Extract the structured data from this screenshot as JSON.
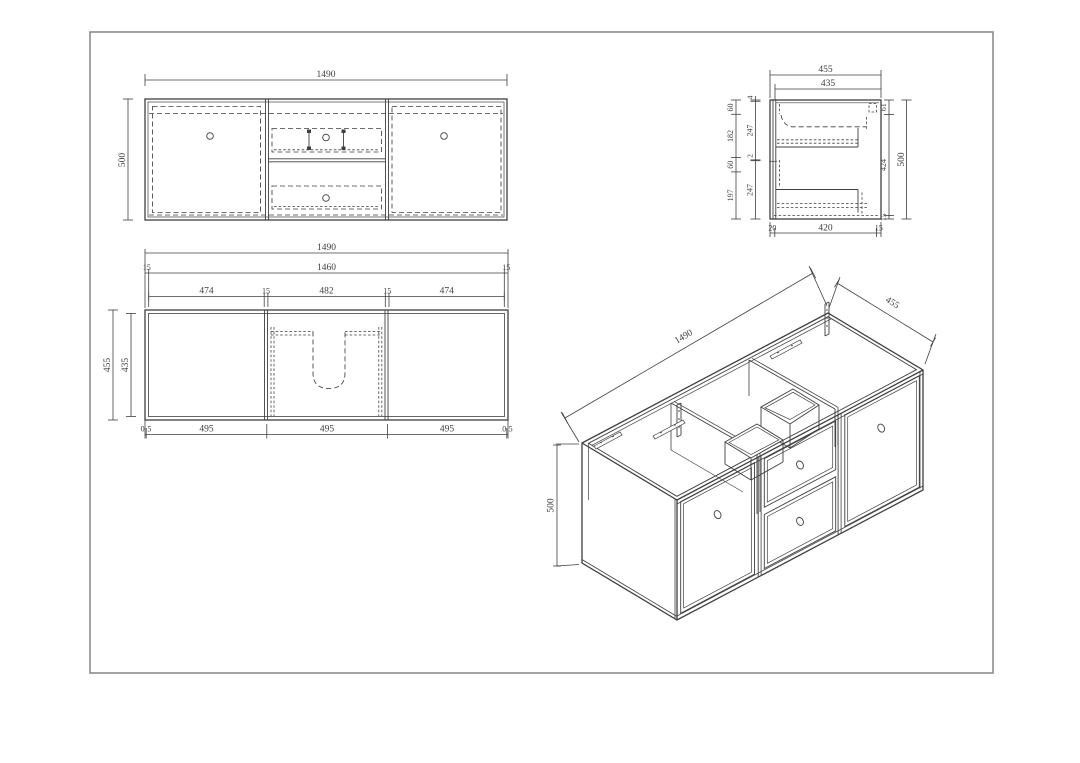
{
  "colors": {
    "line": "#3f3f3f",
    "frame": "#8c8c8c",
    "background": "#ffffff"
  },
  "front": {
    "width": "1490",
    "height": "500"
  },
  "side": {
    "width": "455",
    "inner_width": "435",
    "left_outer": [
      "60",
      "182",
      "60",
      "197"
    ],
    "left_inner": [
      "4",
      "247",
      "2",
      "247"
    ],
    "right_inner": [
      "61",
      "424",
      "15"
    ],
    "drawer_upper": "96",
    "drawer_lower": "96",
    "height": "500",
    "bottom": [
      "20",
      "420",
      "15"
    ]
  },
  "plan": {
    "width": "1490",
    "shell": [
      "15",
      "1460",
      "15"
    ],
    "sections": [
      "474",
      "15",
      "482",
      "15",
      "474"
    ],
    "depth": "455",
    "inner_depth": "435",
    "bottom": [
      "0",
      "5",
      "495",
      "495",
      "495",
      "0",
      "5"
    ]
  },
  "iso": {
    "length": "1490",
    "depth": "455",
    "height": "500"
  }
}
